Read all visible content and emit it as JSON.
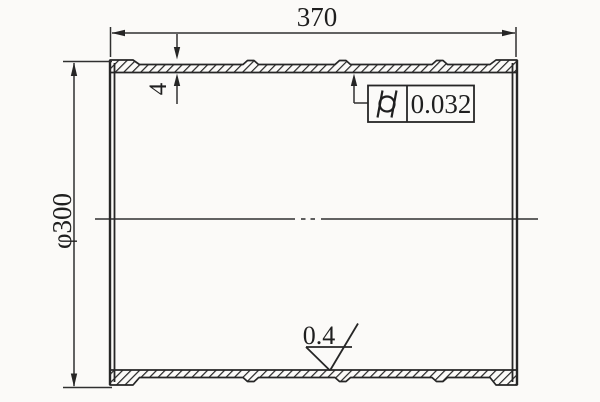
{
  "drawing": {
    "type": "engineering-section-drawing",
    "part": "cylinder liner cross-section",
    "colors": {
      "background": "#fbfaf8",
      "line": "#262626",
      "centerline": "#4d4d4d",
      "text": "#1f1f1f"
    },
    "labels": {
      "length": "370",
      "diameter": "φ300",
      "wall_thickness": "4",
      "cylindricity_tolerance": "0.032",
      "surface_roughness": "0.4"
    },
    "symbols": {
      "tolerance_symbol": "cylindricity-icon",
      "roughness_symbol": "material-removal-surface-icon",
      "centerline_style": "dash-dot"
    }
  }
}
